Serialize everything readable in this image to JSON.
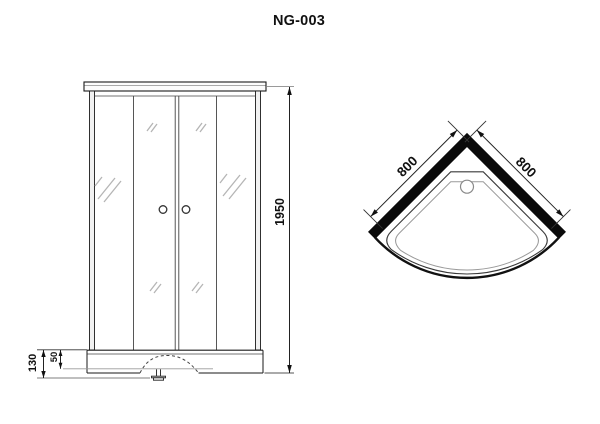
{
  "title": "NG-003",
  "front_view": {
    "label": "front elevation of shower cabin",
    "dimensions": {
      "height": "1950",
      "tray_height": "130",
      "tray_depth": "50"
    }
  },
  "top_view": {
    "label": "plan view of quadrant shower tray",
    "dimensions": {
      "side_left": "800",
      "side_right": "800"
    }
  },
  "colors": {
    "line": "#1a1a1a",
    "wall_fill": "#0a0a0a",
    "light_line": "#9a9a9a",
    "background": "#ffffff"
  }
}
